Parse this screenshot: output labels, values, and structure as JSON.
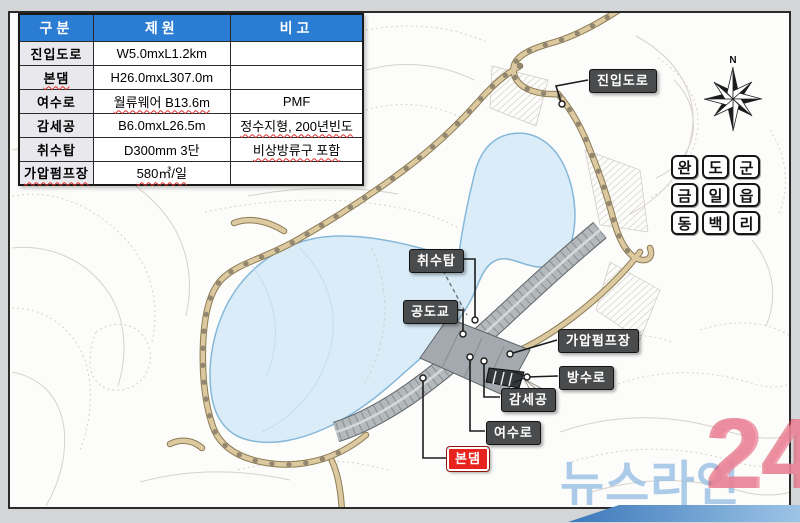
{
  "colors": {
    "header-blue": "#2b7cd3",
    "label-bg": "#4a4b4d",
    "main-dam-red": "#e8221c",
    "lake-fill": "#d9ecf8",
    "road-fill": "#dcc9a0"
  },
  "table": {
    "headers": [
      "구분",
      "제원",
      "비고"
    ],
    "rows": [
      {
        "name": "진입도로",
        "spec": "W5.0mxL1.2km",
        "note": ""
      },
      {
        "name": "본댐",
        "spec": "H26.0mxL307.0m",
        "note": ""
      },
      {
        "name": "여수로",
        "spec": "월류웨어 B13.6m",
        "note": "PMF"
      },
      {
        "name": "감세공",
        "spec": "B6.0mxL26.5m",
        "note": "정수지형, 200년빈도"
      },
      {
        "name": "취수탑",
        "spec": "D300mm 3단",
        "note": "비상방류구 포함"
      },
      {
        "name": "가압펌프장",
        "spec": "580㎥/일",
        "note": ""
      }
    ]
  },
  "map": {
    "labels": [
      {
        "text": "진입도로"
      },
      {
        "text": "취수탑"
      },
      {
        "text": "공도교"
      },
      {
        "text": "가압펌프장"
      },
      {
        "text": "방수로"
      },
      {
        "text": "감세공"
      },
      {
        "text": "여수로"
      },
      {
        "text": "본댐"
      }
    ],
    "region": {
      "chars": [
        "완",
        "도",
        "군",
        "금",
        "일",
        "읍",
        "동",
        "백",
        "리"
      ]
    },
    "compass_n": "N"
  },
  "watermark": {
    "text": "뉴스라인",
    "number": "24"
  }
}
